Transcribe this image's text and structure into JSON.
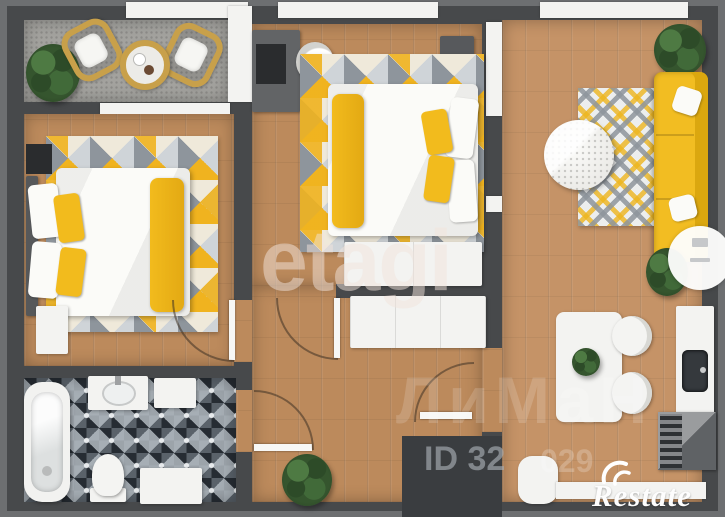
{
  "image": {
    "kind": "3d-apartment-floor-plan",
    "width": 725,
    "height": 517
  },
  "watermarks": {
    "center": "etagi",
    "agency": "ЛиМаН",
    "listing_id_part1": "ID 32",
    "listing_id_part2": "029",
    "brand": "Restate"
  },
  "palette": {
    "wall": "#47494b",
    "wall_outer": "#6d6f71",
    "wood": "#bc8a5c",
    "wood_light": "#c59367",
    "balcony_floor": "#a3a29e",
    "tile": "#262c33",
    "accent_yellow": "#f2bb1d",
    "sofa_yellow": "#f2bd22",
    "white": "#f3f3f1",
    "plant_green": "#35552e"
  }
}
